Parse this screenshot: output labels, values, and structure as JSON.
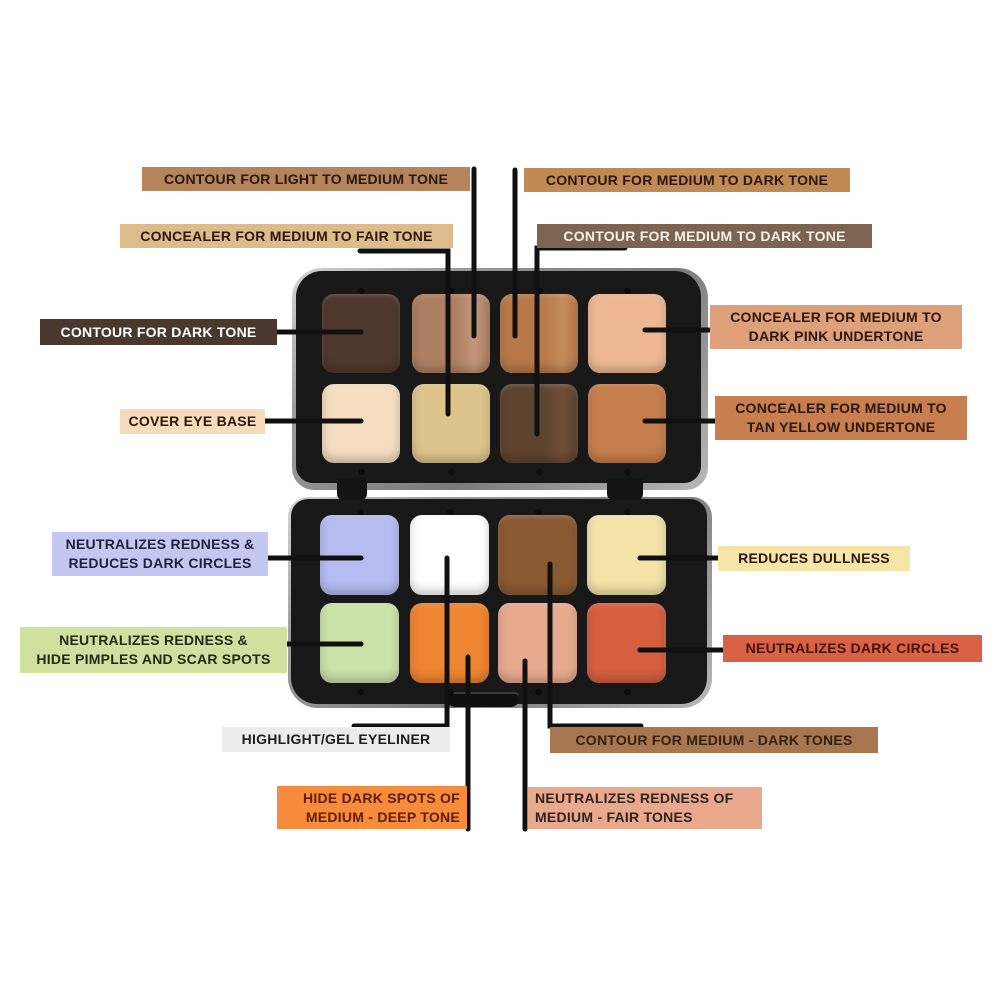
{
  "background": "#ffffff",
  "connector_color": "#101010",
  "palette": {
    "case_color": "#181818",
    "rim_color": "#a8a8a8",
    "top_pans": [
      {
        "id": "contour-for-dark-tone",
        "color": "#4f382e"
      },
      {
        "id": "contour-for-light-to-medium-tone",
        "color": "#ad7e61",
        "color2": "#c3977a"
      },
      {
        "id": "contour-for-medium-to-dark-tone",
        "color": "#b87949",
        "color2": "#c48c5b"
      },
      {
        "id": "concealer-for-medium-to-dark-pink-undertone",
        "color": "#edb893"
      },
      {
        "id": "cover-eye-base",
        "color": "#f4ddc1"
      },
      {
        "id": "concealer-for-medium-to-fair-tone",
        "color": "#dcc48b"
      },
      {
        "id": "contour-for-medium-to-dark-tone-deep",
        "color": "#5e432f",
        "color2": "#6e4f38"
      },
      {
        "id": "concealer-for-medium-to-tan-yellow-undertone",
        "color": "#c67d4d"
      }
    ],
    "bottom_pans": [
      {
        "id": "neutralizes-redness-reduces-dark-circles",
        "color": "#b6bbf1"
      },
      {
        "id": "highlight-gel-eyeliner",
        "color": "#ffffff"
      },
      {
        "id": "contour-for-medium-dark-tones",
        "color": "#8a5a33"
      },
      {
        "id": "reduces-dullness",
        "color": "#f3e3a9"
      },
      {
        "id": "neutralizes-redness-hide-pimples",
        "color": "#cbe2a9"
      },
      {
        "id": "hide-dark-spots",
        "color": "#ef8530"
      },
      {
        "id": "neutralizes-redness-medium-fair",
        "color": "#e8aa8e"
      },
      {
        "id": "neutralizes-dark-circles",
        "color": "#d55f40"
      }
    ]
  },
  "labels": [
    {
      "id": "contour-light-medium-tone",
      "lines": [
        "CONTOUR FOR LIGHT TO MEDIUM TONE"
      ],
      "bg": "#b5835c",
      "fg": "#2a180c"
    },
    {
      "id": "contour-medium-dark-tone-1",
      "lines": [
        "CONTOUR FOR MEDIUM TO DARK TONE"
      ],
      "bg": "#c08a55",
      "fg": "#2a180c"
    },
    {
      "id": "concealer-medium-fair-tone",
      "lines": [
        "CONCEALER FOR MEDIUM TO FAIR TONE"
      ],
      "bg": "#ddbb8b",
      "fg": "#2a180c"
    },
    {
      "id": "contour-medium-dark-tone-2",
      "lines": [
        "CONTOUR FOR MEDIUM TO DARK TONE"
      ],
      "bg": "#7d6450",
      "fg": "#f7f2ec"
    },
    {
      "id": "contour-dark-tone",
      "lines": [
        "CONTOUR FOR DARK TONE"
      ],
      "bg": "#4a382d",
      "fg": "#ffffff"
    },
    {
      "id": "cover-eye-base",
      "lines": [
        "COVER EYE BASE"
      ],
      "bg": "#f6dcba",
      "fg": "#2a180c"
    },
    {
      "id": "neutralizes-redness-dark-circles",
      "lines": [
        "NEUTRALIZES REDNESS &",
        "REDUCES DARK CIRCLES"
      ],
      "bg": "#c5c7f3",
      "fg": "#23203a"
    },
    {
      "id": "neutralizes-redness-pimples",
      "lines": [
        "NEUTRALIZES REDNESS &",
        "HIDE PIMPLES AND SCAR SPOTS"
      ],
      "bg": "#cfe09f",
      "fg": "#222a12"
    },
    {
      "id": "concealer-dark-pink-undertone",
      "lines": [
        "CONCEALER FOR MEDIUM TO",
        "DARK PINK UNDERTONE"
      ],
      "bg": "#de9f7b",
      "fg": "#2a180c"
    },
    {
      "id": "concealer-tan-yellow-undertone",
      "lines": [
        "CONCEALER FOR MEDIUM TO",
        "TAN YELLOW UNDERTONE"
      ],
      "bg": "#c87e4e",
      "fg": "#2a180c"
    },
    {
      "id": "reduces-dullness",
      "lines": [
        "REDUCES DULLNESS"
      ],
      "bg": "#f7e5a8",
      "fg": "#2a180c"
    },
    {
      "id": "neutralizes-dark-circles",
      "lines": [
        "NEUTRALIZES DARK CIRCLES"
      ],
      "bg": "#d96246",
      "fg": "#431306"
    },
    {
      "id": "highlight-gel-eyeliner",
      "lines": [
        "HIGHLIGHT/GEL EYELINER"
      ],
      "bg": "#ececec",
      "fg": "#1d1d1d"
    },
    {
      "id": "contour-medium-dark-tones",
      "lines": [
        "CONTOUR FOR MEDIUM - DARK TONES"
      ],
      "bg": "#a8764f",
      "fg": "#33200f"
    },
    {
      "id": "hide-dark-spots",
      "lines": [
        "HIDE DARK SPOTS OF",
        "MEDIUM - DEEP TONE"
      ],
      "bg": "#f68c3b",
      "fg": "#5c1e06"
    },
    {
      "id": "neutralizes-redness-fair",
      "lines": [
        "NEUTRALIZES REDNESS OF",
        "MEDIUM - FAIR TONES"
      ],
      "bg": "#eaa88c",
      "fg": "#2e2420"
    }
  ]
}
